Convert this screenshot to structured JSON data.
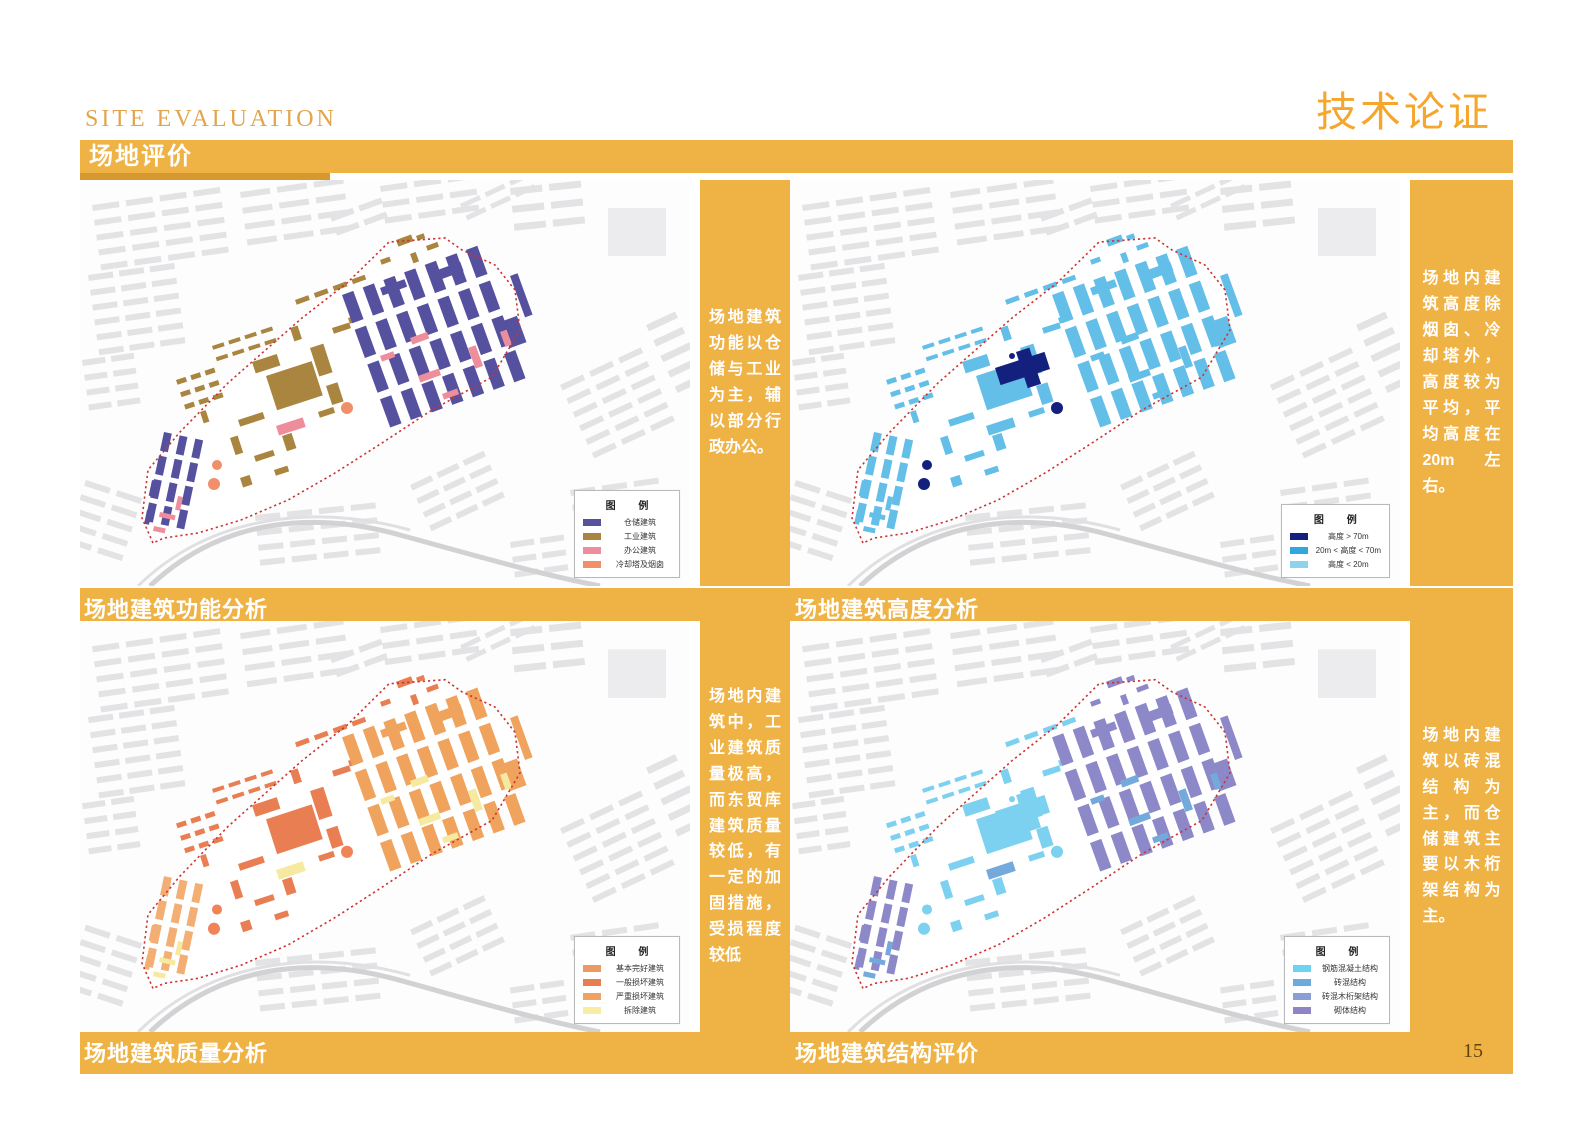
{
  "page": {
    "eyebrow": "SITE EVALUATION",
    "section_title": "场地评价",
    "corner_title": "技术论证",
    "page_number": "15",
    "accent": "#EFB245",
    "accent_dark": "#D6982F",
    "boundary_color": "#CC3333"
  },
  "panels": [
    {
      "caption": "场地建筑功能分析",
      "note": "场地建筑功能以仓储与工业为主，辅以部分行政办公。",
      "legend": {
        "title": "图 例",
        "items": [
          {
            "label": "仓储建筑",
            "color": "#55519E"
          },
          {
            "label": "工业建筑",
            "color": "#A9853F"
          },
          {
            "label": "办公建筑",
            "color": "#EE8E9C"
          },
          {
            "label": "冷却塔及烟囱",
            "color": "#F0906A"
          }
        ]
      },
      "paint": [
        {
          "motif": "industrial",
          "color": "#A9853F"
        },
        {
          "motif": "warehouse_main",
          "color": "#55519E"
        },
        {
          "motif": "warehouse_west",
          "color": "#55519E"
        },
        {
          "motif": "office",
          "color": "#EE8E9C"
        },
        {
          "motif": "chimneys",
          "color": "#A9853F"
        },
        {
          "motif": "towers",
          "color": "#F0906A"
        }
      ]
    },
    {
      "caption": "场地建筑高度分析",
      "note": "场地内建筑高度除烟囱、冷却塔外，高度较为平均，平均高度在20m 左右。",
      "legend": {
        "title": "图 例",
        "items": [
          {
            "label": "高度 > 70m",
            "color": "#14207E"
          },
          {
            "label": "20m < 高度 < 70m",
            "color": "#2FA8E0"
          },
          {
            "label": "高度 < 20m",
            "color": "#8ED2F0"
          }
        ]
      },
      "paint": [
        {
          "motif": "industrial",
          "color": "#63BEE8"
        },
        {
          "motif": "warehouse_main",
          "color": "#63BEE8"
        },
        {
          "motif": "warehouse_west",
          "color": "#63BEE8"
        },
        {
          "motif": "office",
          "color": "#63BEE8"
        },
        {
          "motif": "chimneys",
          "color": "#63BEE8"
        },
        {
          "motif": "landmark",
          "color": "#14207E"
        },
        {
          "motif": "towers",
          "color": "#14207E"
        }
      ]
    },
    {
      "caption": "场地建筑质量分析",
      "note": "场地内建筑中，工业建筑质量极高，而东贸库建筑质量较低，有一定的加固措施，受损程度较低",
      "legend": {
        "title": "图 例",
        "items": [
          {
            "label": "基本完好建筑",
            "color": "#EA9A62"
          },
          {
            "label": "一般损坏建筑",
            "color": "#E67E52"
          },
          {
            "label": "严重损坏建筑",
            "color": "#F0A263"
          },
          {
            "label": "拆除建筑",
            "color": "#F6EEA2"
          }
        ]
      },
      "paint": [
        {
          "motif": "industrial",
          "color": "#E87E52"
        },
        {
          "motif": "warehouse_main",
          "color": "#F0A35C"
        },
        {
          "motif": "warehouse_west",
          "color": "#F3AE74"
        },
        {
          "motif": "office",
          "color": "#F6E9A0"
        },
        {
          "motif": "chimneys",
          "color": "#E87E52"
        },
        {
          "motif": "towers",
          "color": "#F08456"
        }
      ]
    },
    {
      "caption": "场地建筑结构评价",
      "note": "场地内建筑以砖混结构为主，而仓储建筑主要以木桁架结构为主。",
      "legend": {
        "title": "图 例",
        "items": [
          {
            "label": "钢筋混凝土结构",
            "color": "#6ED3F2"
          },
          {
            "label": "砖混结构",
            "color": "#6FAADC"
          },
          {
            "label": "砖混木桁架结构",
            "color": "#8A9FD6"
          },
          {
            "label": "砌体结构",
            "color": "#8D85C4"
          }
        ]
      },
      "paint": [
        {
          "motif": "industrial",
          "color": "#7CD1F0"
        },
        {
          "motif": "warehouse_main",
          "color": "#8D88C8"
        },
        {
          "motif": "warehouse_west",
          "color": "#8D88C8"
        },
        {
          "motif": "office",
          "color": "#74A9DC"
        },
        {
          "motif": "chimneys",
          "color": "#8D88C8"
        },
        {
          "motif": "landmark",
          "color": "#7CD1F0"
        },
        {
          "motif": "towers",
          "color": "#7CD1F0"
        }
      ]
    }
  ],
  "base": {
    "fabric_color": "#E3E3E5",
    "boundary": "73,363 62,338 68,290 100,252 148,203 222,138 267,103 309,62 365,58 382,70 415,85 435,110 440,150 412,197 352,230 302,263 255,293 208,320 161,340 118,353 84,358",
    "fabric": [
      {
        "t": "grid",
        "x": 12,
        "y": 25,
        "rows": 5,
        "cols": 4,
        "cw": 27,
        "ch": 6,
        "gx": 7,
        "gy": 9,
        "rot": -8
      },
      {
        "t": "grid",
        "x": 160,
        "y": 12,
        "rows": 4,
        "cols": 3,
        "cw": 30,
        "ch": 6,
        "gx": 7,
        "gy": 10,
        "rot": -8
      },
      {
        "t": "grid",
        "x": 300,
        "y": 6,
        "rows": 3,
        "cols": 3,
        "cw": 27,
        "ch": 6,
        "gx": 7,
        "gy": 10,
        "rot": -8
      },
      {
        "t": "grid",
        "x": 430,
        "y": 8,
        "rows": 3,
        "cols": 2,
        "cw": 32,
        "ch": 7,
        "gx": 7,
        "gy": 11,
        "rot": -6
      },
      {
        "t": "rect",
        "x": 528,
        "y": 28,
        "w": 58,
        "h": 48,
        "c": "#ECECEE"
      },
      {
        "t": "grid",
        "x": 8,
        "y": 95,
        "rows": 6,
        "cols": 3,
        "cw": 25,
        "ch": 6,
        "gx": 6,
        "gy": 9,
        "rot": -8
      },
      {
        "t": "grid",
        "x": 2,
        "y": 180,
        "rows": 4,
        "cols": 2,
        "cw": 23,
        "ch": 6,
        "gx": 6,
        "gy": 9,
        "rot": -8
      },
      {
        "t": "grid",
        "x": 6,
        "y": 300,
        "rows": 5,
        "cols": 2,
        "cw": 26,
        "ch": 6,
        "gx": 7,
        "gy": 9,
        "rot": 18
      },
      {
        "t": "grid",
        "x": 175,
        "y": 335,
        "rows": 4,
        "cols": 4,
        "cw": 25,
        "ch": 6,
        "gx": 7,
        "gy": 9,
        "rot": -6
      },
      {
        "t": "grid",
        "x": 330,
        "y": 305,
        "rows": 4,
        "cols": 3,
        "cw": 23,
        "ch": 6,
        "gx": 6,
        "gy": 9,
        "rot": -25
      },
      {
        "t": "grid",
        "x": 480,
        "y": 205,
        "rows": 6,
        "cols": 3,
        "cw": 25,
        "ch": 6,
        "gx": 7,
        "gy": 9,
        "rot": -25
      },
      {
        "t": "grid",
        "x": 490,
        "y": 310,
        "rows": 5,
        "cols": 3,
        "cw": 25,
        "ch": 6,
        "gx": 7,
        "gy": 9,
        "rot": -8
      },
      {
        "t": "grid",
        "x": 566,
        "y": 145,
        "rows": 5,
        "cols": 1,
        "cw": 32,
        "ch": 7,
        "gx": 6,
        "gy": 10,
        "rot": -25
      },
      {
        "t": "grid",
        "x": 380,
        "y": 24,
        "rows": 2,
        "cols": 3,
        "cw": 21,
        "ch": 5,
        "gx": 6,
        "gy": 8,
        "rot": -25
      },
      {
        "t": "grid",
        "x": 250,
        "y": 36,
        "rows": 2,
        "cols": 2,
        "cw": 24,
        "ch": 6,
        "gx": 6,
        "gy": 9,
        "rot": -20
      },
      {
        "t": "grid",
        "x": 430,
        "y": 362,
        "rows": 3,
        "cols": 2,
        "cw": 24,
        "ch": 6,
        "gx": 6,
        "gy": 9,
        "rot": -8
      }
    ],
    "roads": [
      {
        "t": "path",
        "d": "M 70 406 C 140 340 230 330 320 355 C 390 374 450 392 520 406",
        "c": "#D2D2D4",
        "sw": 5
      },
      {
        "t": "path",
        "d": "M 58 406 C 132 334 236 324 330 350",
        "c": "#E0E0E2",
        "sw": 3
      }
    ],
    "motifs": {
      "warehouse_main": [
        {
          "t": "grid",
          "x": 262,
          "y": 115,
          "rows": 4,
          "cols": 7,
          "cw": 12,
          "ch": 30,
          "gx": 10,
          "gy": 7,
          "rot": -20
        },
        {
          "t": "rect",
          "x": 430,
          "y": 96,
          "w": 8,
          "h": 44,
          "rot": -20
        },
        {
          "t": "rect",
          "x": 420,
          "y": 142,
          "w": 18,
          "h": 28,
          "rot": -20
        },
        {
          "t": "rect",
          "x": 352,
          "y": 92,
          "w": 30,
          "h": 10,
          "rot": -20
        },
        {
          "t": "rect",
          "x": 300,
          "y": 108,
          "w": 26,
          "h": 8,
          "rot": -20
        }
      ],
      "warehouse_west": [
        {
          "t": "grid",
          "x": 84,
          "y": 252,
          "rows": 4,
          "cols": 3,
          "cw": 8,
          "ch": 19,
          "gx": 8,
          "gy": 5,
          "rot": 12
        },
        {
          "t": "rect",
          "x": 72,
          "y": 300,
          "w": 6,
          "h": 16,
          "rot": 12
        },
        {
          "t": "rect",
          "x": 67,
          "y": 330,
          "w": 5,
          "h": 14,
          "rot": 12
        }
      ],
      "industrial": [
        {
          "t": "rect",
          "x": 186,
          "y": 196,
          "w": 48,
          "h": 36,
          "rot": -18
        },
        {
          "t": "rect",
          "x": 172,
          "y": 182,
          "w": 26,
          "h": 12,
          "rot": -18
        },
        {
          "t": "rect",
          "x": 230,
          "y": 168,
          "w": 14,
          "h": 30,
          "rot": -18
        },
        {
          "t": "rect",
          "x": 246,
          "y": 206,
          "w": 12,
          "h": 20,
          "rot": -18
        },
        {
          "t": "grid",
          "x": 96,
          "y": 200,
          "rows": 3,
          "cols": 3,
          "cw": 10,
          "ch": 5,
          "gx": 5,
          "gy": 8,
          "rot": -18
        },
        {
          "t": "grid",
          "x": 132,
          "y": 166,
          "rows": 2,
          "cols": 4,
          "cw": 12,
          "ch": 4,
          "gx": 5,
          "gy": 8,
          "rot": -18
        },
        {
          "t": "rect",
          "x": 252,
          "y": 148,
          "w": 18,
          "h": 6,
          "rot": -18
        },
        {
          "t": "rect",
          "x": 268,
          "y": 138,
          "w": 10,
          "h": 6,
          "rot": -18
        },
        {
          "t": "rect",
          "x": 210,
          "y": 148,
          "w": 8,
          "h": 14,
          "rot": -18
        },
        {
          "t": "rect",
          "x": 158,
          "y": 240,
          "w": 26,
          "h": 7,
          "rot": -18
        },
        {
          "t": "rect",
          "x": 150,
          "y": 258,
          "w": 8,
          "h": 18,
          "rot": -18
        },
        {
          "t": "rect",
          "x": 174,
          "y": 276,
          "w": 20,
          "h": 6,
          "rot": -18
        },
        {
          "t": "rect",
          "x": 194,
          "y": 290,
          "w": 14,
          "h": 6,
          "rot": -18
        },
        {
          "t": "rect",
          "x": 160,
          "y": 298,
          "w": 10,
          "h": 10,
          "rot": -18
        },
        {
          "t": "rect",
          "x": 202,
          "y": 256,
          "w": 10,
          "h": 16,
          "rot": -18
        },
        {
          "t": "grid",
          "x": 215,
          "y": 120,
          "rows": 1,
          "cols": 4,
          "cw": 14,
          "ch": 5,
          "gx": 6,
          "gy": 0,
          "rot": -20
        },
        {
          "t": "rect",
          "x": 238,
          "y": 232,
          "w": 16,
          "h": 6,
          "rot": -18
        },
        {
          "t": "rect",
          "x": 120,
          "y": 232,
          "w": 6,
          "h": 12,
          "rot": -18
        }
      ],
      "office": [
        {
          "t": "rect",
          "x": 196,
          "y": 246,
          "w": 28,
          "h": 10,
          "rot": -18
        },
        {
          "t": "rect",
          "x": 330,
          "y": 158,
          "w": 18,
          "h": 7,
          "rot": -20
        },
        {
          "t": "rect",
          "x": 388,
          "y": 168,
          "w": 8,
          "h": 22,
          "rot": -20
        },
        {
          "t": "rect",
          "x": 338,
          "y": 196,
          "w": 22,
          "h": 7,
          "rot": -20
        },
        {
          "t": "rect",
          "x": 300,
          "y": 176,
          "w": 14,
          "h": 6,
          "rot": -20
        },
        {
          "t": "rect",
          "x": 362,
          "y": 214,
          "w": 16,
          "h": 6,
          "rot": -20
        },
        {
          "t": "rect",
          "x": 80,
          "y": 332,
          "w": 16,
          "h": 5,
          "rot": 12
        },
        {
          "t": "rect",
          "x": 98,
          "y": 316,
          "w": 5,
          "h": 14,
          "rot": 12
        },
        {
          "t": "rect",
          "x": 74,
          "y": 346,
          "w": 12,
          "h": 5,
          "rot": 12
        },
        {
          "t": "rect",
          "x": 420,
          "y": 152,
          "w": 7,
          "h": 16,
          "rot": -20
        }
      ],
      "chimneys": [
        {
          "t": "rect",
          "x": 316,
          "y": 60,
          "w": 16,
          "h": 7,
          "rot": -20
        },
        {
          "t": "rect",
          "x": 336,
          "y": 56,
          "w": 8,
          "h": 5,
          "rot": -20
        },
        {
          "t": "rect",
          "x": 346,
          "y": 66,
          "w": 12,
          "h": 5,
          "rot": -20
        },
        {
          "t": "rect",
          "x": 330,
          "y": 74,
          "w": 6,
          "h": 10,
          "rot": -20
        },
        {
          "t": "rect",
          "x": 300,
          "y": 80,
          "w": 10,
          "h": 5,
          "rot": -20
        }
      ],
      "landmark": [
        {
          "t": "rect",
          "x": 205,
          "y": 188,
          "w": 52,
          "h": 18,
          "rot": -18
        },
        {
          "t": "rect",
          "x": 226,
          "y": 172,
          "w": 14,
          "h": 38,
          "rot": -18
        },
        {
          "t": "circle",
          "cx": 222,
          "cy": 176,
          "r": 3
        }
      ],
      "towers": [
        {
          "t": "circle",
          "cx": 267,
          "cy": 228,
          "r": 6
        },
        {
          "t": "circle",
          "cx": 137,
          "cy": 285,
          "r": 5
        },
        {
          "t": "circle",
          "cx": 134,
          "cy": 304,
          "r": 6
        }
      ]
    }
  }
}
